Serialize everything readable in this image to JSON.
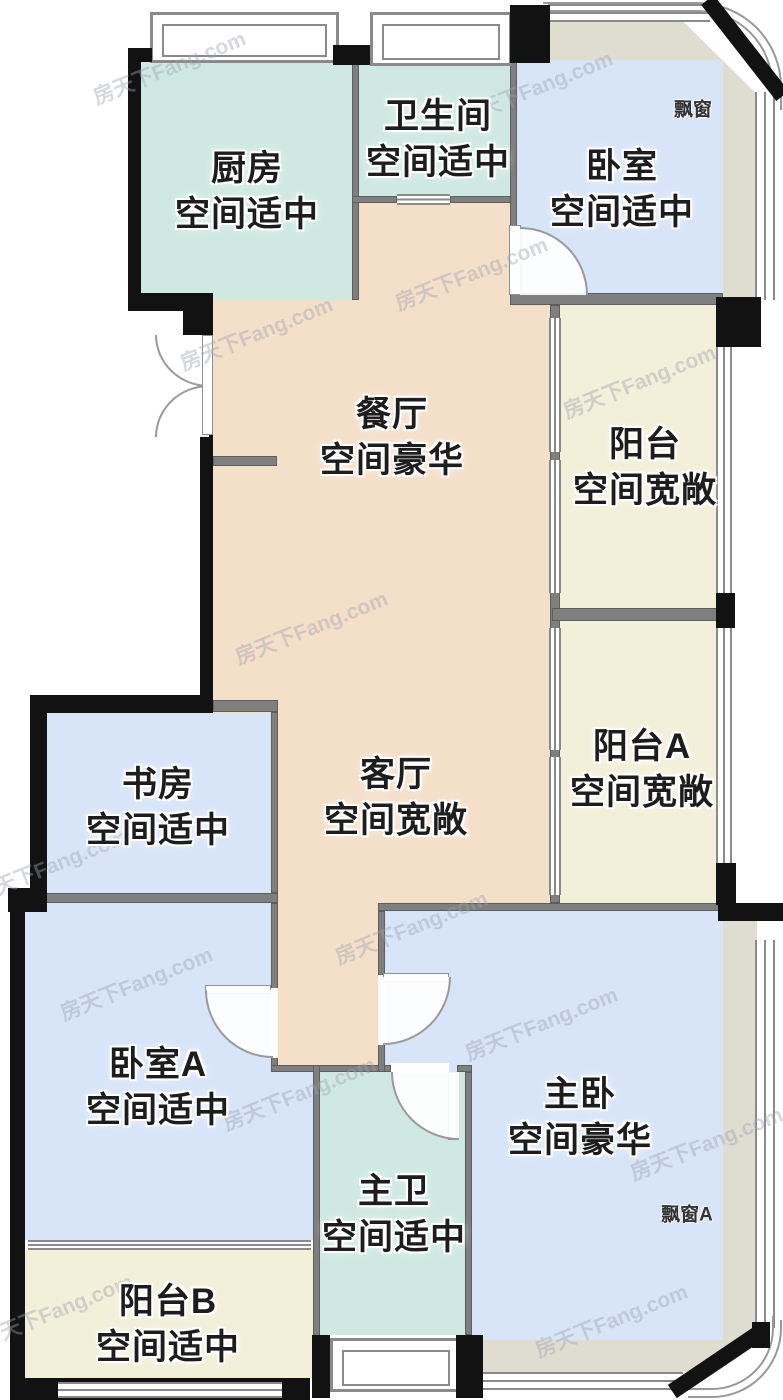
{
  "watermark": {
    "text": "房天下Fang.com"
  },
  "colors": {
    "room_teal": "#cfe9e2",
    "room_blue": "#d8e5f8",
    "room_peach": "#f4dfc9",
    "room_cream": "#f2f0d9",
    "bay_platform": "#dfddd0",
    "wall_black": "#121212",
    "wall_gray": "#7f7f7f"
  },
  "rooms": [
    {
      "id": "kitchen",
      "name": "厨房",
      "size_label": "空间适中"
    },
    {
      "id": "bathroom",
      "name": "卫生间",
      "size_label": "空间适中"
    },
    {
      "id": "bedroom",
      "name": "卧室",
      "size_label": "空间适中"
    },
    {
      "id": "dining",
      "name": "餐厅",
      "size_label": "空间豪华"
    },
    {
      "id": "balcony",
      "name": "阳台",
      "size_label": "空间宽敞"
    },
    {
      "id": "balcony-a",
      "name": "阳台A",
      "size_label": "空间宽敞"
    },
    {
      "id": "study",
      "name": "书房",
      "size_label": "空间适中"
    },
    {
      "id": "living",
      "name": "客厅",
      "size_label": "空间宽敞"
    },
    {
      "id": "bedroom-a",
      "name": "卧室A",
      "size_label": "空间适中"
    },
    {
      "id": "master-bedroom",
      "name": "主卧",
      "size_label": "空间豪华"
    },
    {
      "id": "master-bath",
      "name": "主卫",
      "size_label": "空间适中"
    },
    {
      "id": "balcony-b",
      "name": "阳台B",
      "size_label": "空间适中"
    }
  ],
  "bay_windows": [
    {
      "label": "飘窗"
    },
    {
      "label": "飘窗A"
    }
  ]
}
